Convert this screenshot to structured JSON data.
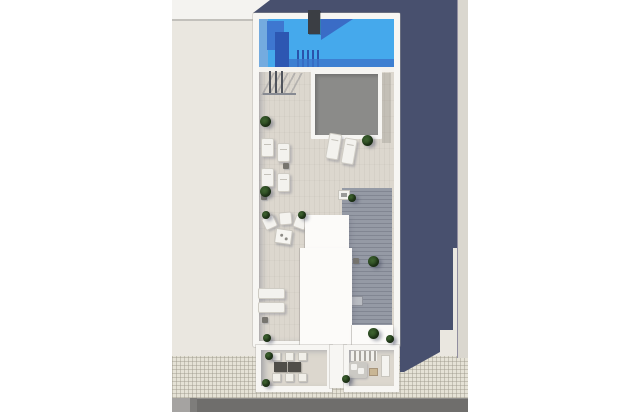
{
  "meta": {
    "title": "Rooftop aerial 3D render",
    "description": "Top-down photorealistic architectural render of a narrow building rooftop: swimming pool at the top, tiled sun deck with skylight, sun loungers, lounge seating, wooden side deck with planters, two rear terraces (dining set and lounge corner), sidewalk and road at the bottom, long slate-blue shadow cast to the right."
  },
  "scene": {
    "photo_alt": "Aerial view of a rooftop terrace with blue swimming pool, gray skylight, white sun loungers, green potted plants, two lower terraces with dining and lounge furniture, a tiled sidewalk and asphalt road below, and a long building shadow falling to the right",
    "objects": [
      "swimming-pool",
      "pool-steps",
      "rooftop-skylight",
      "stair-railing",
      "sun-loungers",
      "lounge-armchairs",
      "coffee-table",
      "wood-plank-deck",
      "potted-plants",
      "penthouse-roofs",
      "dining-terrace",
      "lounge-terrace",
      "dining-table-set",
      "corner-sofa",
      "sidewalk",
      "road",
      "building-shadow",
      "neighbor-roof"
    ],
    "counts": {
      "sun_loungers": 8,
      "armchairs": 3,
      "dining_chairs": 6,
      "dining_tables": 2,
      "plants": 13,
      "terraces": 2,
      "pools": 1,
      "skylights": 1
    }
  },
  "palette": {
    "page_bg": "#ffffff",
    "ground": "#eae7e0",
    "neighbor_roof": "#f4f3f0",
    "shadow": "#48506e",
    "pool_blue": "#45a9ec",
    "pool_shadow_blue": "#3e77d0",
    "pool_deep_blue": "#2d57b2",
    "parapet": "#f7f6f3",
    "deck_tile": "#dcd7ce",
    "skylight": "#8b8b89",
    "plank": "#959aa5",
    "plant": "#26421d",
    "road": "#6f6e6c",
    "sidewalk": "#e5e2d6",
    "lit_strip": "#dad7cf",
    "furniture_white": "#f3f2ee"
  }
}
